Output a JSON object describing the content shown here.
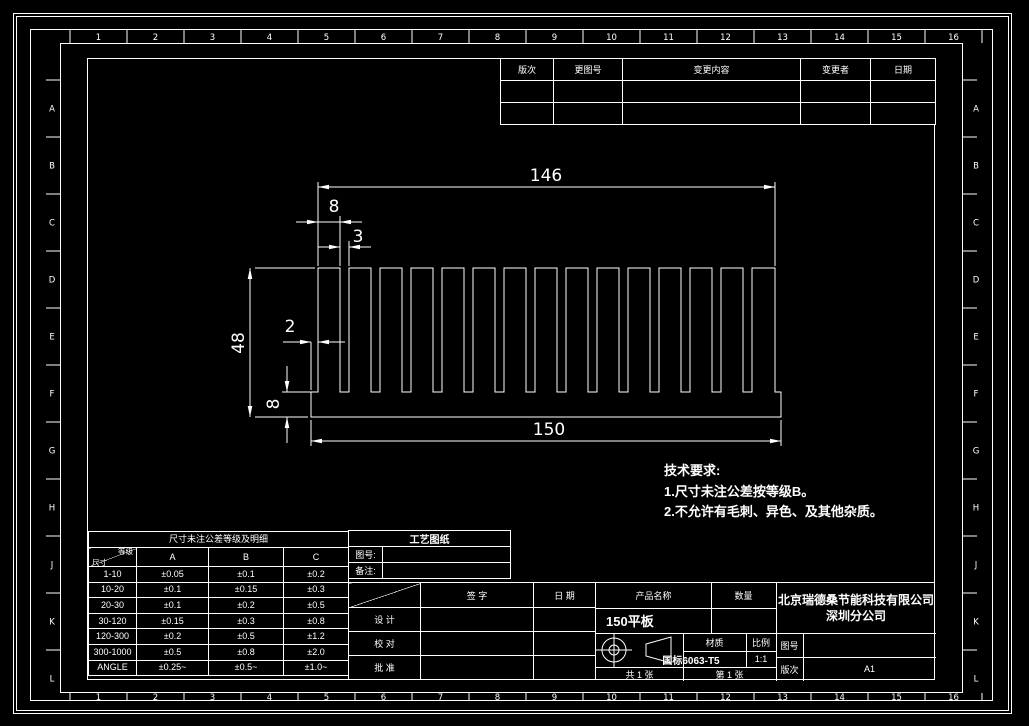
{
  "zones": {
    "top_numbers": [
      "1",
      "2",
      "3",
      "4",
      "5",
      "6",
      "7",
      "8",
      "9",
      "10",
      "11",
      "12",
      "13",
      "14",
      "15",
      "16"
    ],
    "left_letters": [
      "A",
      "B",
      "C",
      "D",
      "E",
      "F",
      "G",
      "H",
      "J",
      "K",
      "L"
    ]
  },
  "revision_table": {
    "headers": [
      "版次",
      "更图号",
      "变更内容",
      "变更者",
      "日期"
    ]
  },
  "dimensions": {
    "fin_span": "146",
    "fin_width": "8",
    "slot_width": "3",
    "height": "48",
    "edge_offset": "2",
    "base_thickness": "8",
    "base_width": "150"
  },
  "tech_requirements": {
    "title": "技术要求:",
    "item1": "1.尺寸未注公差按等级B。",
    "item2": "2.不允许有毛刺、异色、及其他杂质。"
  },
  "tolerance_table": {
    "title": "尺寸未注公差等级及明细",
    "corner_top": "等级",
    "corner_bottom": "尺寸",
    "columns": [
      "A",
      "B",
      "C"
    ],
    "rows": [
      {
        "range": "1-10",
        "values": [
          "±0.05",
          "±0.1",
          "±0.2"
        ]
      },
      {
        "range": "10-20",
        "values": [
          "±0.1",
          "±0.15",
          "±0.3"
        ]
      },
      {
        "range": "20-30",
        "values": [
          "±0.1",
          "±0.2",
          "±0.5"
        ]
      },
      {
        "range": "30-120",
        "values": [
          "±0.15",
          "±0.3",
          "±0.8"
        ]
      },
      {
        "range": "120-300",
        "values": [
          "±0.2",
          "±0.5",
          "±1.2"
        ]
      },
      {
        "range": "300-1000",
        "values": [
          "±0.5",
          "±0.8",
          "±2.0"
        ]
      },
      {
        "range": "ANGLE",
        "values": [
          "±0.25~",
          "±0.5~",
          "±1.0~"
        ]
      }
    ]
  },
  "process_box": {
    "title": "工艺图纸",
    "row1_label": "图号:",
    "row2_label": "备注:"
  },
  "signature_table": {
    "col_sign": "签 字",
    "col_date": "日 期",
    "row_design": "设 计",
    "row_check": "校 对",
    "row_approve": "批 准"
  },
  "title_block": {
    "product_label": "产品名称",
    "qty_label": "数量",
    "product_name": "150平板",
    "company_line1": "北京瑞德桑节能科技有限公司",
    "company_line2": "深圳分公司",
    "material_label": "材质",
    "material_value": "国标6063-T5",
    "scale_label": "比例",
    "scale_value": "1:1",
    "drawing_no_label": "图号",
    "rev_label": "版次",
    "rev_value": "A1",
    "sheet_total": "共 1 张",
    "sheet_no": "第 1 张"
  }
}
